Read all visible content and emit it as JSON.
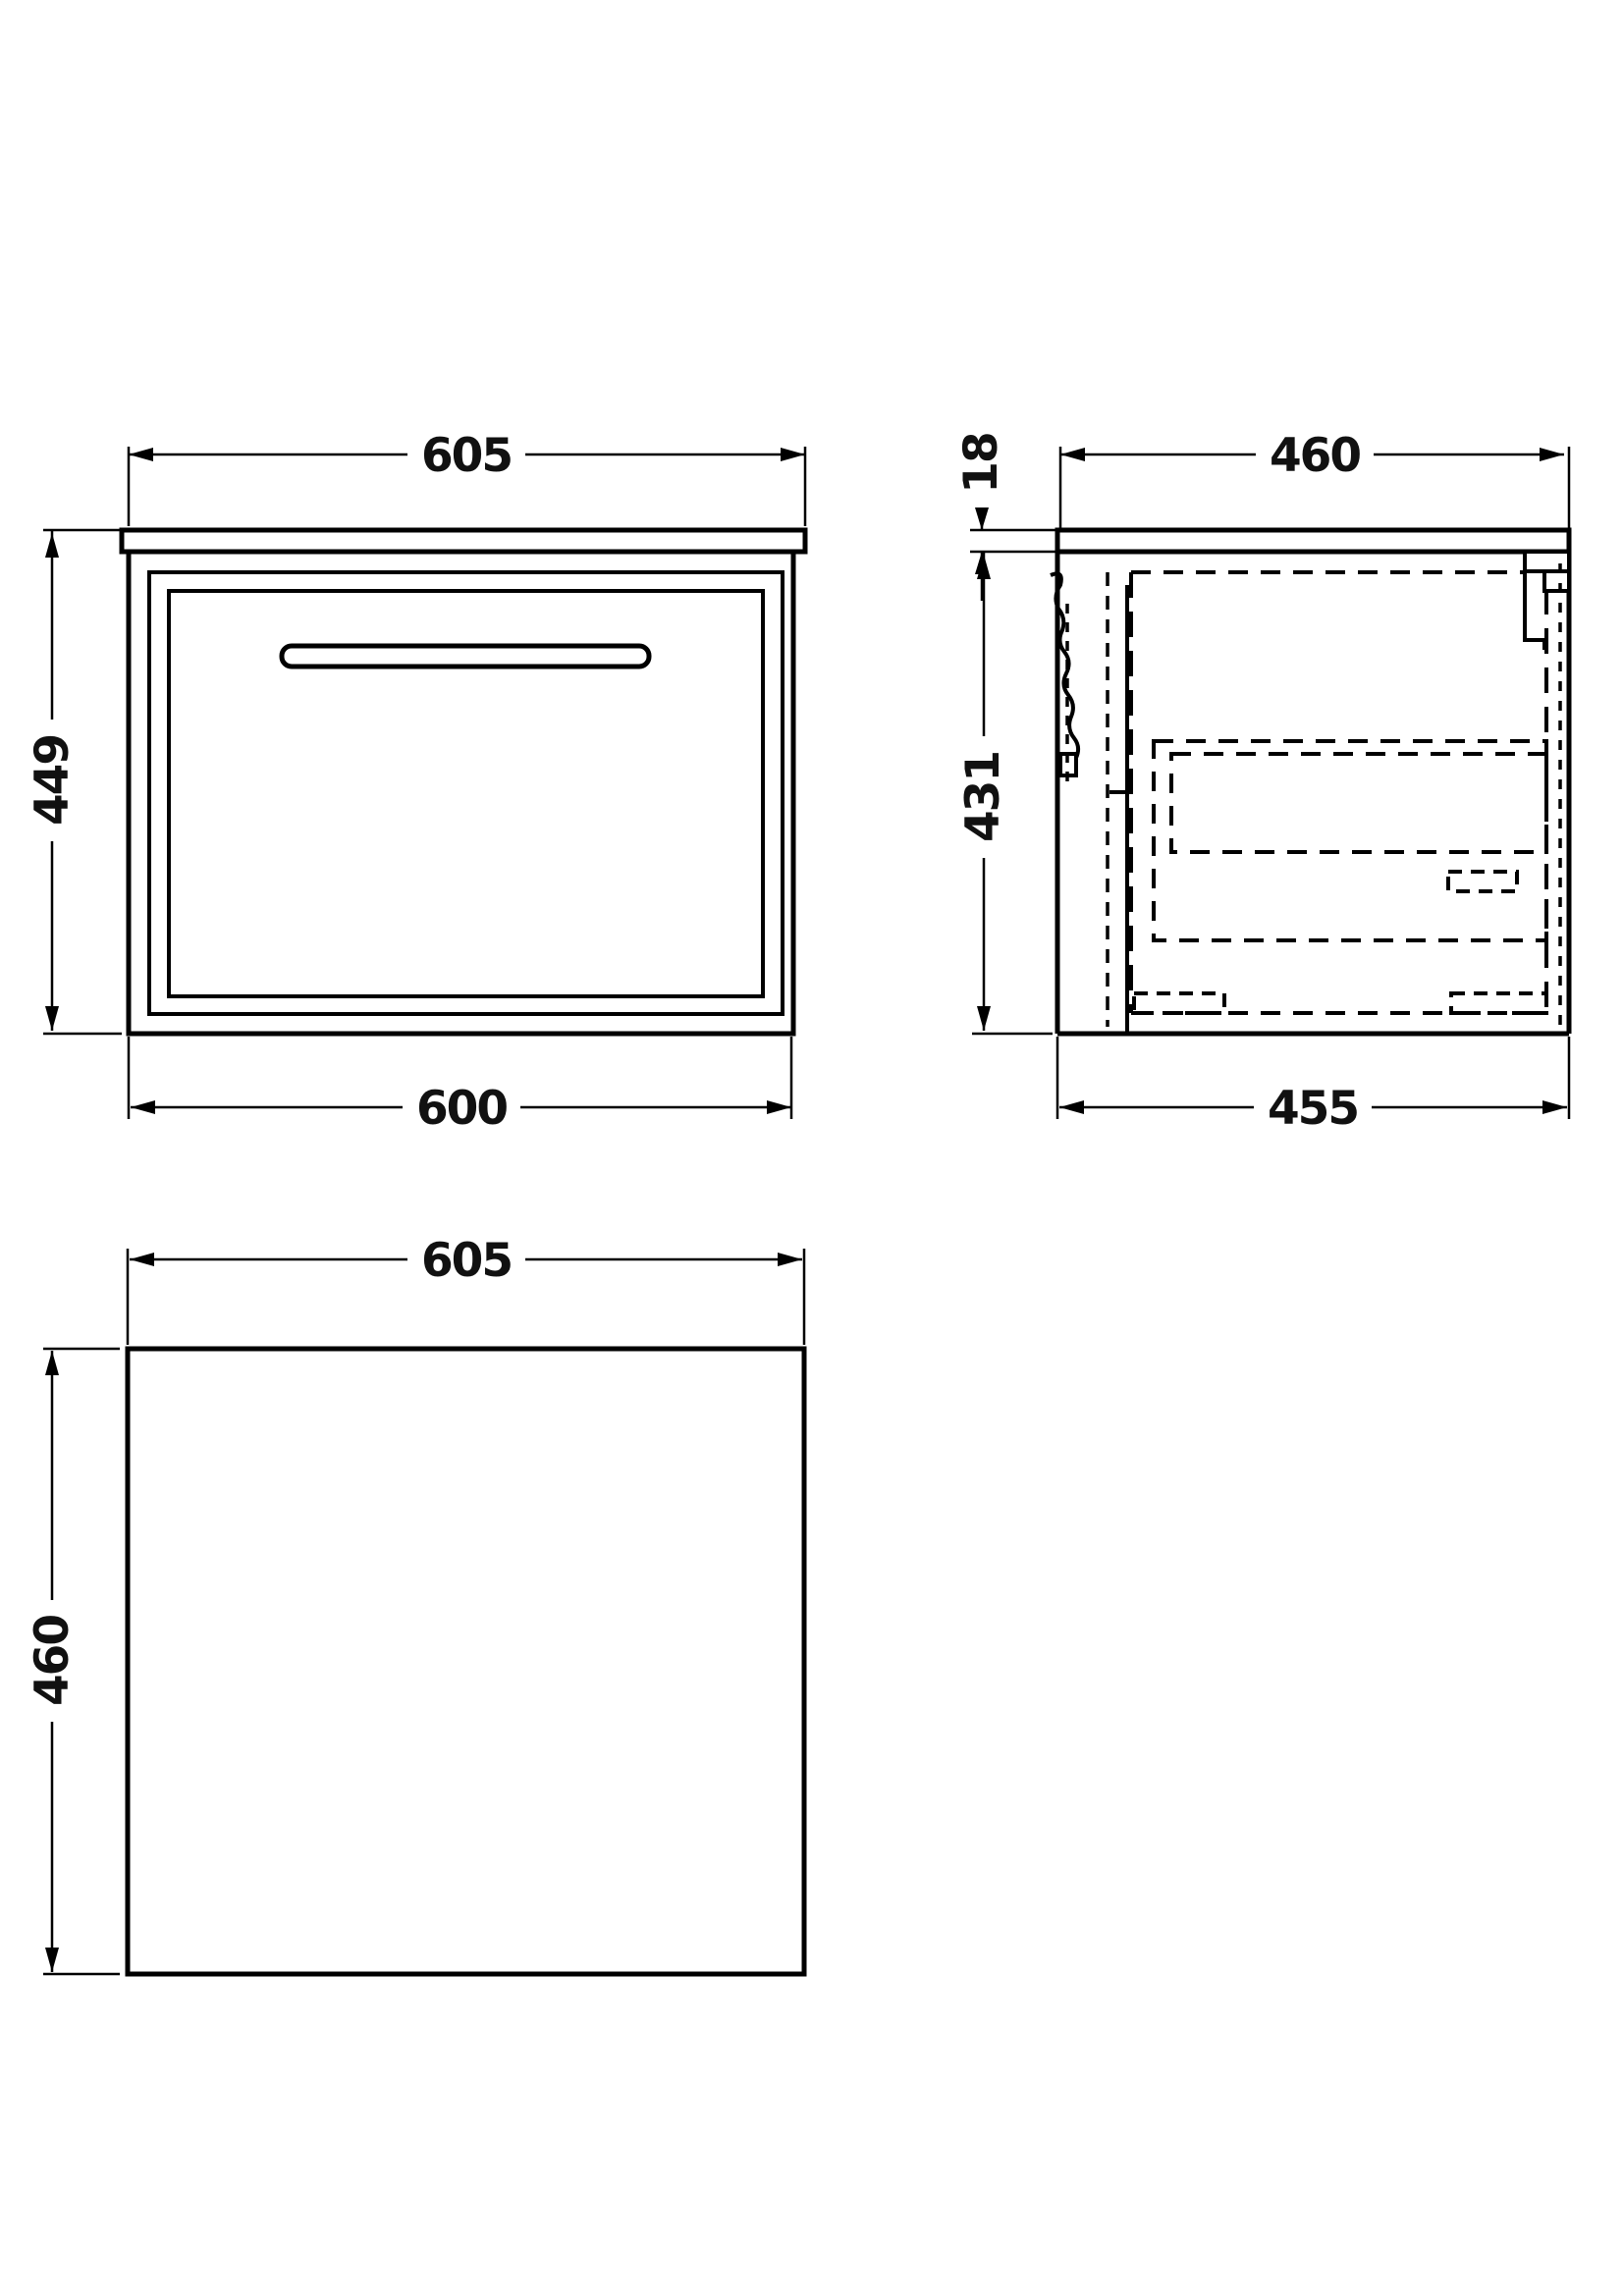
{
  "drawing_type": "technical-dimension-drawing",
  "unit_views": {
    "front": {
      "dim_width_top": "605",
      "dim_height_left": "449",
      "dim_width_bottom": "600"
    },
    "side": {
      "dim_depth_top": "460",
      "dim_worktop_thickness": "18",
      "dim_body_height": "431",
      "dim_depth_bottom": "455"
    },
    "plan": {
      "dim_width_top": "605",
      "dim_depth_left": "460"
    }
  },
  "colors": {
    "line": "#000000",
    "background": "#ffffff"
  }
}
